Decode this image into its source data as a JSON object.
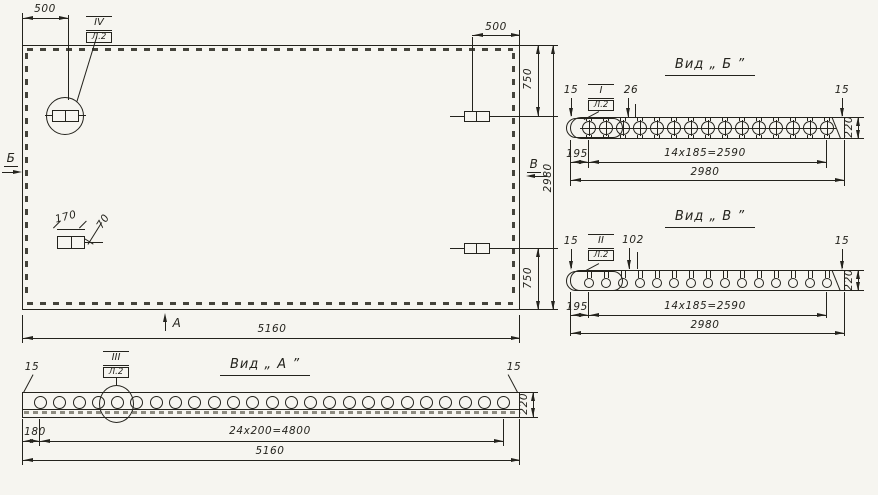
{
  "colors": {
    "ink": "#24231d",
    "paper": "#f6f5f0"
  },
  "panel_plan": {
    "dim_top_left": "500",
    "dim_top_right": "500",
    "dim_right_top": "750",
    "dim_right_bottom": "750",
    "dim_right_total": "2980",
    "dim_bottom_total": "5160",
    "embed_width": "170",
    "embed_offset": "70",
    "callout": {
      "num": "IV",
      "sheet": "Л.2"
    },
    "view_marks": {
      "left": "Б",
      "right": "В",
      "bottom": "А"
    }
  },
  "view_b": {
    "title": "Вид „ Б ”",
    "callout": {
      "num": "I",
      "sheet": "Л.2"
    },
    "hole_count": 15,
    "dims": {
      "lip_left": "15",
      "lip_right": "15",
      "hole_note": "26",
      "edge_offset": "195",
      "spacing": "14x185=2590",
      "total": "2980",
      "height": "220"
    }
  },
  "view_v": {
    "title": "Вид „ В ”",
    "callout": {
      "num": "II",
      "sheet": "Л.2"
    },
    "hole_count": 15,
    "dims": {
      "lip_left": "15",
      "lip_right": "15",
      "hole_note": "102",
      "edge_offset": "195",
      "spacing": "14x185=2590",
      "total": "2980",
      "height": "220"
    }
  },
  "view_a": {
    "title": "Вид „ А ”",
    "callout": {
      "num": "III",
      "sheet": "Л.2"
    },
    "hole_count": 25,
    "dims": {
      "lip_left": "15",
      "lip_right": "15",
      "edge_offset": "180",
      "spacing": "24x200=4800",
      "total": "5160",
      "height": "220"
    }
  }
}
